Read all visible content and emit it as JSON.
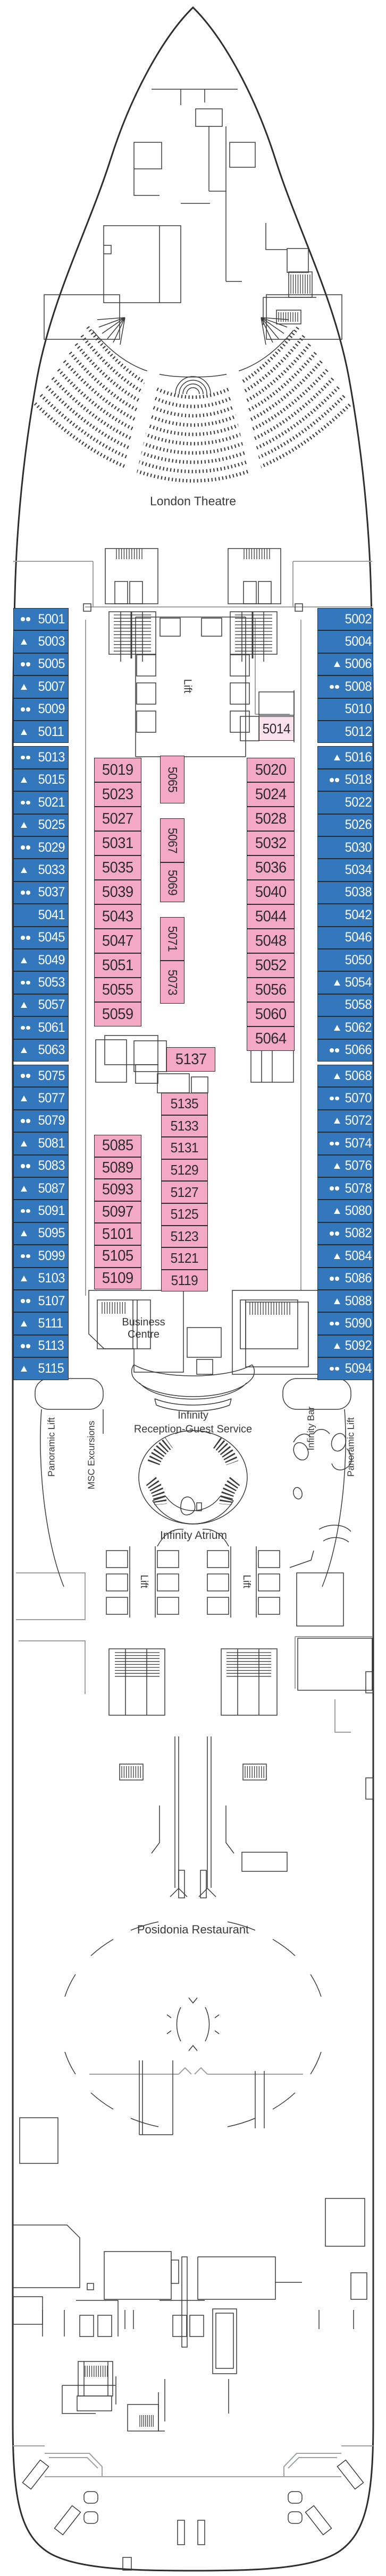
{
  "title": "Ship deck plan - Deck 5",
  "labels": {
    "london_theatre": "London Theatre",
    "lift": "Lift",
    "business_centre": "Business Centre",
    "panoramic_lift": "Panoramic Lift",
    "msc_excursions": "MSC Excursions",
    "infinity_bar": "Infinity Bar",
    "infinity": "Infinity",
    "reception_guest_service": "Reception-Guest Service",
    "infinity_atrium": "Infinity Atrium",
    "posidonia_restaurant": "Posidonia Restaurant"
  },
  "colors": {
    "cabin_blue": "#3377BD",
    "cabin_pink": "#F3A9C4",
    "cabin_pink_light": "#F9E2EC",
    "line": "#3a3a3c",
    "line_gray": "#9ca0a3",
    "hull": "#2d2e30",
    "text_on_blue": "#FFFFFF",
    "text_on_pink": "#2f2b2c"
  },
  "cabins": {
    "port_column": [
      {
        "n": "5001",
        "icon": "dots"
      },
      {
        "n": "5003",
        "icon": "triangle"
      },
      {
        "n": "5005",
        "icon": "dots"
      },
      {
        "n": "5007",
        "icon": "triangle"
      },
      {
        "n": "5009",
        "icon": "dots"
      },
      {
        "n": "5011",
        "icon": "triangle"
      },
      {
        "n": "5013",
        "icon": "dots"
      },
      {
        "n": "5015",
        "icon": "triangle"
      },
      {
        "n": "5021",
        "icon": "dots"
      },
      {
        "n": "5025",
        "icon": "triangle"
      },
      {
        "n": "5029",
        "icon": "dots"
      },
      {
        "n": "5033",
        "icon": "triangle"
      },
      {
        "n": "5037",
        "icon": "dots"
      },
      {
        "n": "5041",
        "icon": null
      },
      {
        "n": "5045",
        "icon": "dots"
      },
      {
        "n": "5049",
        "icon": "triangle"
      },
      {
        "n": "5053",
        "icon": "dots"
      },
      {
        "n": "5057",
        "icon": "triangle"
      },
      {
        "n": "5061",
        "icon": "dots"
      },
      {
        "n": "5063",
        "icon": "triangle"
      },
      {
        "n": "5075",
        "icon": "dots"
      },
      {
        "n": "5077",
        "icon": "triangle"
      },
      {
        "n": "5079",
        "icon": "dots"
      },
      {
        "n": "5081",
        "icon": "triangle"
      },
      {
        "n": "5083",
        "icon": "dots"
      },
      {
        "n": "5087",
        "icon": "triangle"
      },
      {
        "n": "5091",
        "icon": "dots"
      },
      {
        "n": "5095",
        "icon": "triangle"
      },
      {
        "n": "5099",
        "icon": "dots"
      },
      {
        "n": "5103",
        "icon": "triangle"
      },
      {
        "n": "5107",
        "icon": "dots"
      },
      {
        "n": "5111",
        "icon": "triangle"
      },
      {
        "n": "5113",
        "icon": "dots"
      },
      {
        "n": "5115",
        "icon": "triangle"
      }
    ],
    "starboard_column": [
      {
        "n": "5002",
        "icon": null
      },
      {
        "n": "5004",
        "icon": null
      },
      {
        "n": "5006",
        "icon": "triangle"
      },
      {
        "n": "5008",
        "icon": "dots"
      },
      {
        "n": "5010",
        "icon": null
      },
      {
        "n": "5012",
        "icon": null
      },
      {
        "n": "5016",
        "icon": "triangle"
      },
      {
        "n": "5018",
        "icon": "dots"
      },
      {
        "n": "5022",
        "icon": null
      },
      {
        "n": "5026",
        "icon": null
      },
      {
        "n": "5030",
        "icon": null
      },
      {
        "n": "5034",
        "icon": null
      },
      {
        "n": "5038",
        "icon": null
      },
      {
        "n": "5042",
        "icon": null
      },
      {
        "n": "5046",
        "icon": null
      },
      {
        "n": "5050",
        "icon": null
      },
      {
        "n": "5054",
        "icon": "triangle"
      },
      {
        "n": "5058",
        "icon": null
      },
      {
        "n": "5062",
        "icon": "triangle"
      },
      {
        "n": "5066",
        "icon": "dots"
      },
      {
        "n": "5068",
        "icon": "triangle"
      },
      {
        "n": "5070",
        "icon": "dots"
      },
      {
        "n": "5072",
        "icon": "triangle"
      },
      {
        "n": "5074",
        "icon": "dots"
      },
      {
        "n": "5076",
        "icon": "triangle"
      },
      {
        "n": "5078",
        "icon": "dots"
      },
      {
        "n": "5080",
        "icon": "triangle"
      },
      {
        "n": "5082",
        "icon": "dots"
      },
      {
        "n": "5084",
        "icon": "triangle"
      },
      {
        "n": "5086",
        "icon": "dots"
      },
      {
        "n": "5088",
        "icon": "triangle"
      },
      {
        "n": "5090",
        "icon": "dots"
      },
      {
        "n": "5092",
        "icon": "triangle"
      },
      {
        "n": "5094",
        "icon": "dots"
      }
    ],
    "mid_left_forward": [
      "5019",
      "5023",
      "5027",
      "5031",
      "5035",
      "5039",
      "5043",
      "5047",
      "5051",
      "5055",
      "5059"
    ],
    "mid_right_forward": [
      "5020",
      "5024",
      "5028",
      "5032",
      "5036",
      "5040",
      "5044",
      "5048",
      "5052",
      "5056",
      "5060",
      "5064"
    ],
    "center_vertical": [
      "5065",
      "5067",
      "5069",
      "5071",
      "5073"
    ],
    "mid_left_aft": [
      "5085",
      "5089",
      "5093",
      "5097",
      "5101",
      "5105",
      "5109"
    ],
    "inner_aft": [
      "5135",
      "5133",
      "5131",
      "5129",
      "5127",
      "5125",
      "5123",
      "5121",
      "5119"
    ],
    "special_light": "5014",
    "special_wide": "5137"
  }
}
